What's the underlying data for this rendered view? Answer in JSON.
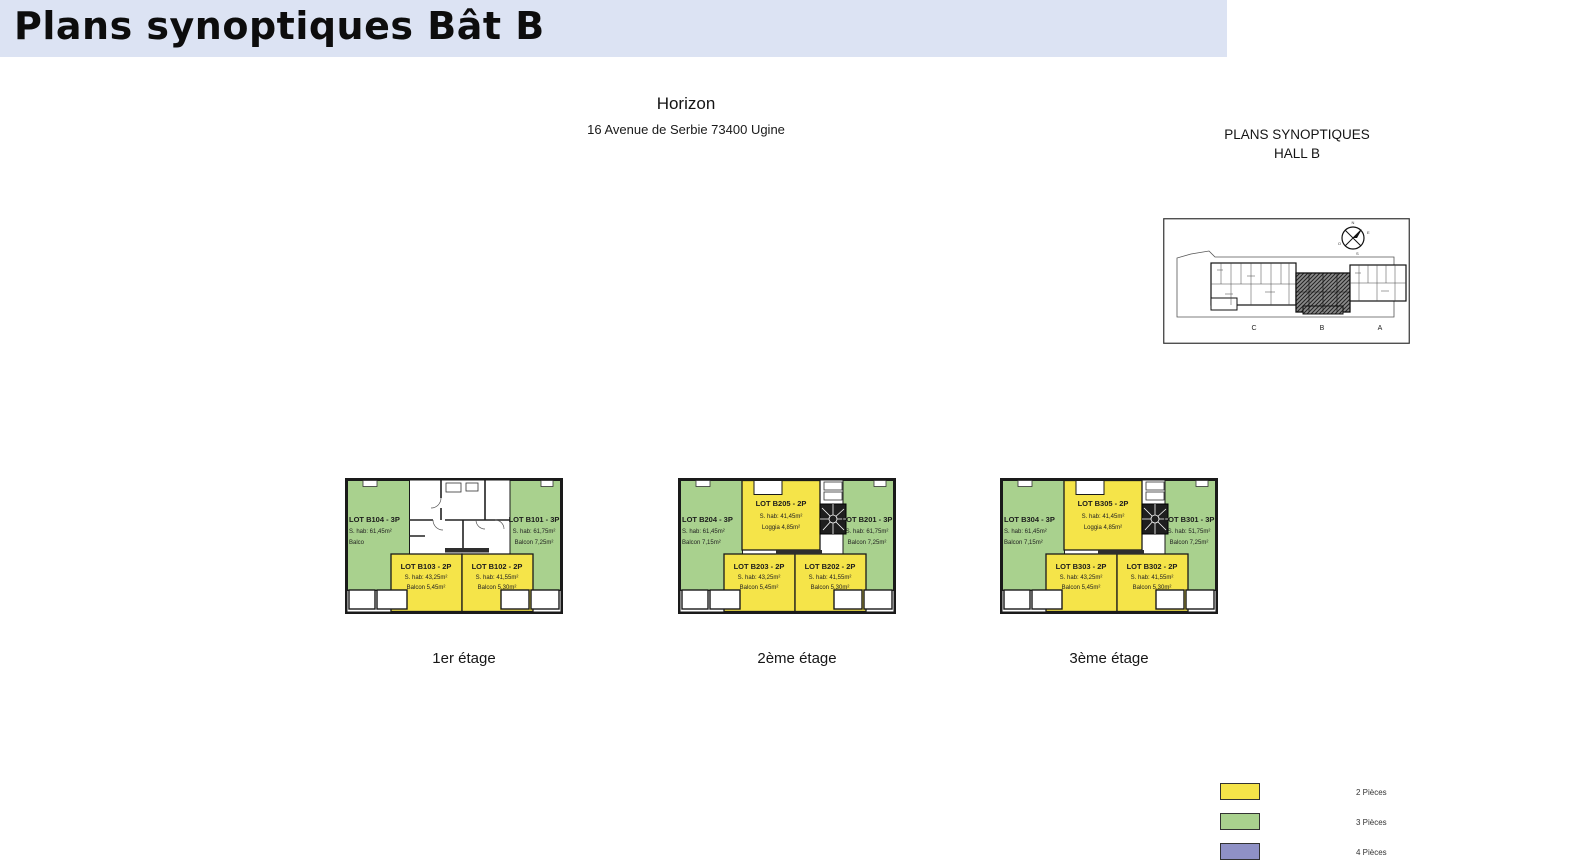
{
  "header": {
    "title": "Plans synoptiques Bât B"
  },
  "project": {
    "name": "Horizon",
    "address": "16 Avenue de Serbie 73400 Ugine"
  },
  "site_plan": {
    "title_line1": "PLANS SYNOPTIQUES",
    "title_line2": "HALL B",
    "building_labels": [
      "C",
      "B",
      "A"
    ],
    "compass": {
      "north": "N",
      "south": "S",
      "east": "E",
      "west": "O"
    }
  },
  "floors": [
    {
      "caption": "1er étage",
      "unit_left": {
        "lot": "LOT B104 - 3P",
        "area": "S. hab: 61,45m²",
        "balcony": "Balco"
      },
      "unit_right": {
        "lot": "LOT B101 - 3P",
        "area": "S. hab: 61,75m²",
        "balcony": "Balcon 7,25m²"
      },
      "unit_top": null,
      "unit_bottom_left": {
        "lot": "LOT B103 - 2P",
        "area": "S. hab: 43,25m²",
        "balcony": "Balcon 5,45m²"
      },
      "unit_bottom_right": {
        "lot": "LOT B102 - 2P",
        "area": "S. hab: 41,55m²",
        "balcony": "Balcon 5,30m²"
      }
    },
    {
      "caption": "2ème étage",
      "unit_left": {
        "lot": "LOT B204 - 3P",
        "area": "S. hab: 61,45m²",
        "balcony": "Balcon 7,15m²"
      },
      "unit_right": {
        "lot": "LOT B201 - 3P",
        "area": "S. hab: 61,75m²",
        "balcony": "Balcon 7,25m²"
      },
      "unit_top": {
        "lot": "LOT B205 - 2P",
        "area": "S. hab: 41,45m²",
        "balcony": "Loggia 4,85m²"
      },
      "unit_bottom_left": {
        "lot": "LOT B203 - 2P",
        "area": "S. hab: 43,25m²",
        "balcony": "Balcon 5,45m²"
      },
      "unit_bottom_right": {
        "lot": "LOT B202 - 2P",
        "area": "S. hab: 41,55m²",
        "balcony": "Balcon 5,30m²"
      }
    },
    {
      "caption": "3ème étage",
      "unit_left": {
        "lot": "LOT B304 - 3P",
        "area": "S. hab: 61,45m²",
        "balcony": "Balcon 7,15m²"
      },
      "unit_right": {
        "lot": "LOT B301 - 3P",
        "area": "S. hab: 51,75m²",
        "balcony": "Balcon 7,25m²"
      },
      "unit_top": {
        "lot": "LOT B305 - 2P",
        "area": "S. hab: 41,45m²",
        "balcony": "Loggia 4,85m²"
      },
      "unit_bottom_left": {
        "lot": "LOT B303 - 2P",
        "area": "S. hab: 43,25m²",
        "balcony": "Balcon 5,45m²"
      },
      "unit_bottom_right": {
        "lot": "LOT B302 - 2P",
        "area": "S. hab: 41,55m²",
        "balcony": "Balcon 5,30m²"
      }
    }
  ],
  "legend": {
    "items": [
      {
        "label": "2 Pièces",
        "color": "#f5e449"
      },
      {
        "label": "3 Pièces",
        "color": "#a9d18e"
      },
      {
        "label": "4 Pièces",
        "color": "#8f91c6"
      }
    ]
  },
  "colors": {
    "header_bg": "#dce3f3",
    "plan_wall": "#1a1a1a"
  }
}
